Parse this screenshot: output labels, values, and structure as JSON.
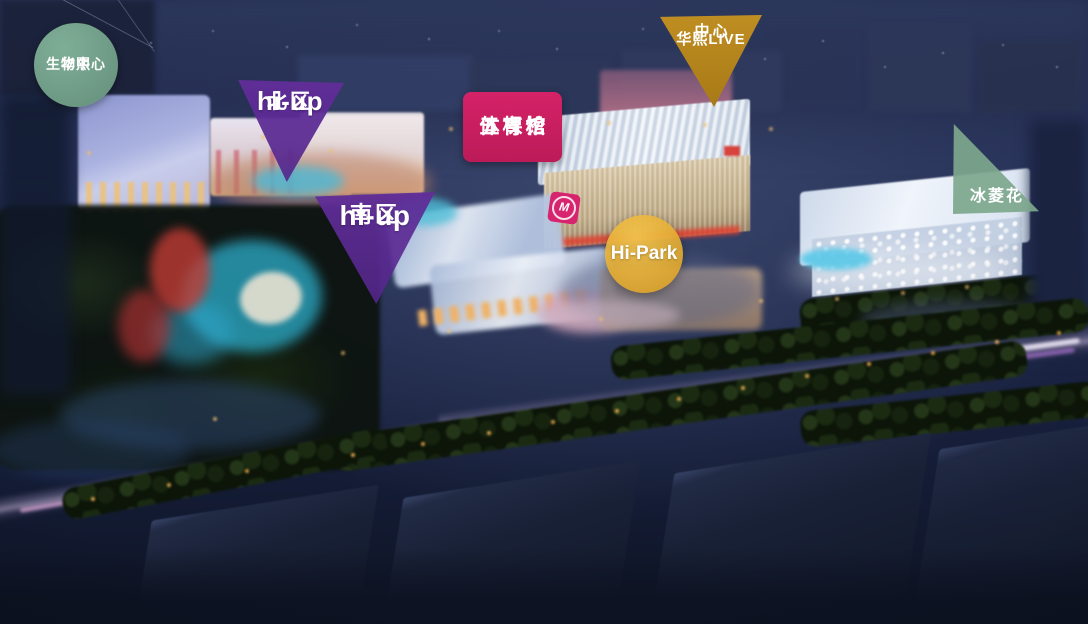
{
  "markers": {
    "bio_center": {
      "shape": "circle",
      "color": "#6E9C87",
      "line1": "华熙",
      "line2": "生物中心"
    },
    "hi_up_north": {
      "shape": "triangle-down",
      "color": "#5F2C98",
      "line1": "hi-up",
      "line2": "北区"
    },
    "hi_up_south": {
      "shape": "triangle-down",
      "color": "#5F2C98",
      "line1": "hi-up",
      "line2": "南区"
    },
    "wukesong_arena": {
      "shape": "rounded-square",
      "color": "#C91E5F",
      "line1": "五棵松",
      "line2": "体育馆"
    },
    "huaxi_live_center": {
      "shape": "triangle-down",
      "color": "#B5861F",
      "line1": "华熙LIVE",
      "line2": "中心"
    },
    "hi_park": {
      "shape": "circle",
      "color": "#E0A42C",
      "line1": "Hi-Park"
    },
    "ice_flower": {
      "shape": "right-triangle",
      "color": "#7DA78D",
      "line1": "冰菱花"
    }
  },
  "photo": {
    "arena_logo": "M"
  }
}
